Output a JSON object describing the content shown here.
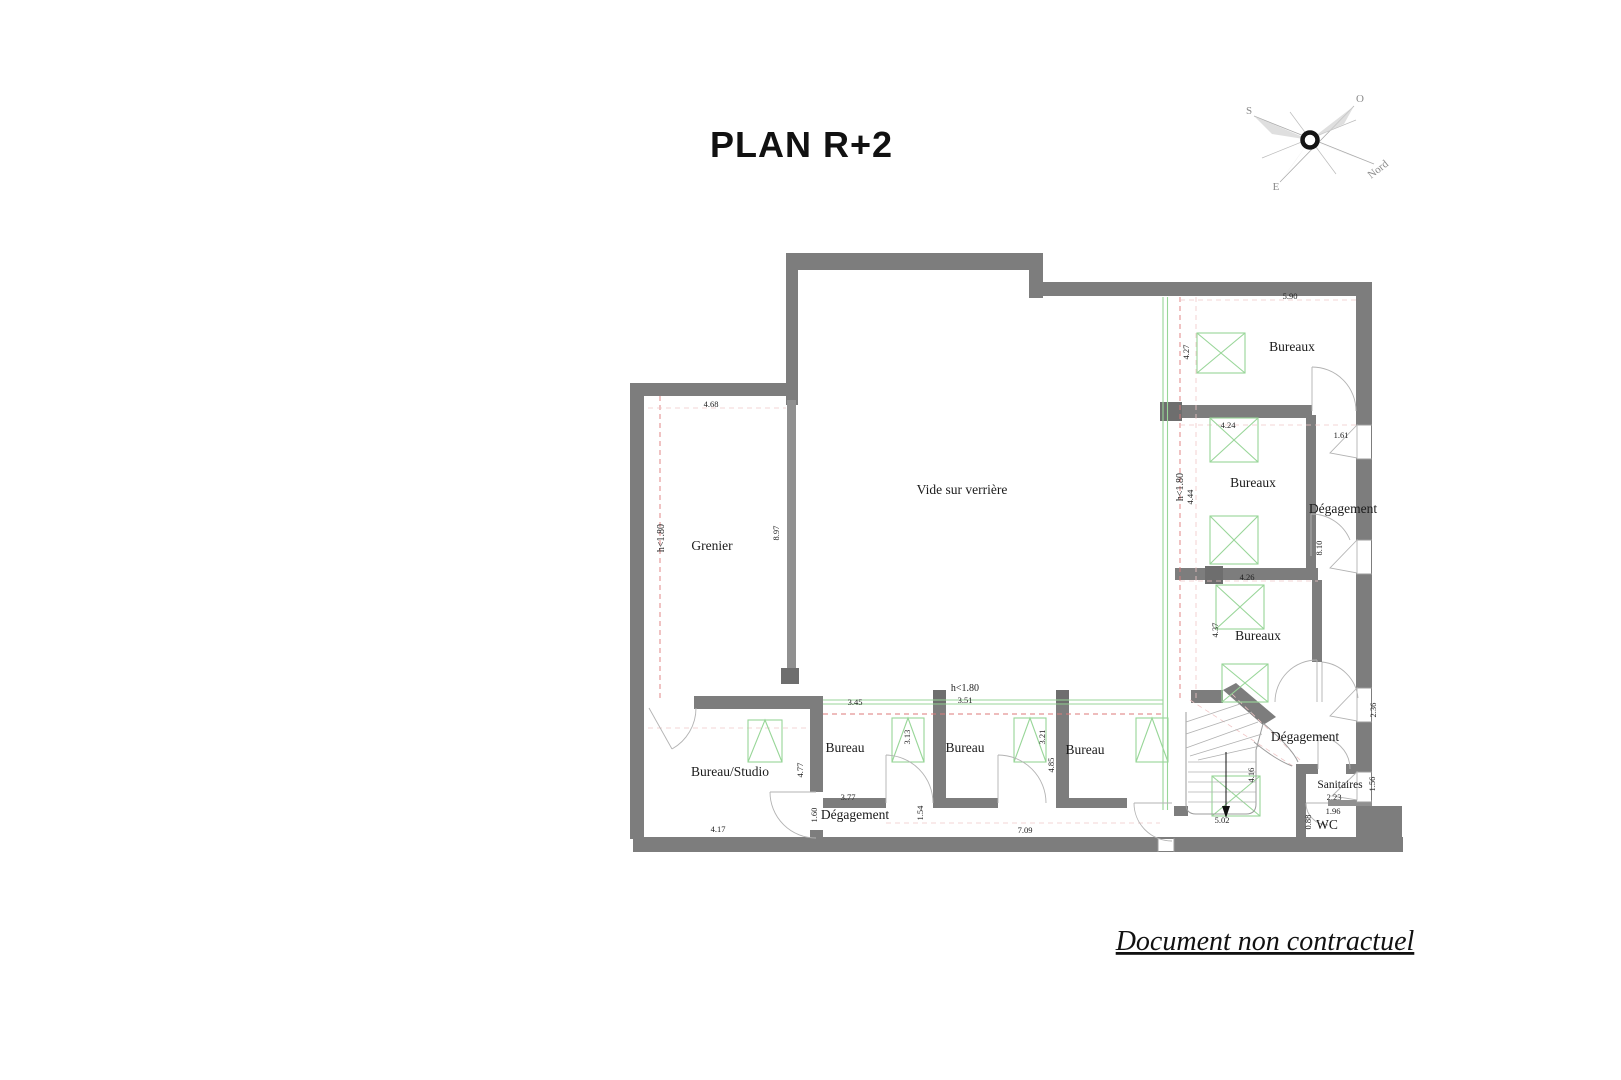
{
  "title": "PLAN R+2",
  "footer": "Document non contractuel",
  "compass": {
    "o": "O",
    "s": "S",
    "e": "E",
    "nord": "Nord"
  },
  "rooms": {
    "grenier": {
      "label": "Grenier",
      "h_limit": "h<1.80",
      "dim_top": "4.68",
      "dim_side": "8.97"
    },
    "vide": {
      "label": "Vide sur verrière"
    },
    "bureaux_top": {
      "label": "Bureaux",
      "dim_top": "5.90",
      "dim_side": "4.27"
    },
    "bureaux_mid": {
      "label": "Bureaux",
      "h_limit": "h<1.80",
      "dim_top": "4.24",
      "dim_side": "4.44",
      "dim_wall": "8.10"
    },
    "bureaux_low": {
      "label": "Bureaux",
      "dim_top": "4.26",
      "dim_side": "4.37"
    },
    "degagement_right": {
      "label": "Dégagement",
      "dim_top": "1.61"
    },
    "bureau_studio": {
      "label": "Bureau/Studio",
      "dim_bottom": "4.17",
      "dim_side": "4.77"
    },
    "bureau1": {
      "label": "Bureau",
      "dim_top": "3.45",
      "dim_side": "3.13"
    },
    "bureau2": {
      "label": "Bureau",
      "h_limit": "h<1.80",
      "dim_top": "3.51",
      "dim_side": "3.21"
    },
    "bureau3": {
      "label": "Bureau",
      "dim_side": "4.85"
    },
    "degagement_bottom": {
      "label": "Dégagement",
      "dim_top": "3.77",
      "dim_left": "1.60",
      "dim_mid": "1.54",
      "dim_length": "7.09"
    },
    "degagement_se": {
      "label": "Dégagement",
      "dim_side": "4.16",
      "dim_wall": "2.36",
      "dim_bottom": "5.02"
    },
    "sanitaires": {
      "label": "Sanitaires",
      "dim_side": "1.56",
      "dim_width": "2.23"
    },
    "wc": {
      "label": "WC",
      "dim_top": "1.96",
      "dim_side": "0.88"
    }
  }
}
